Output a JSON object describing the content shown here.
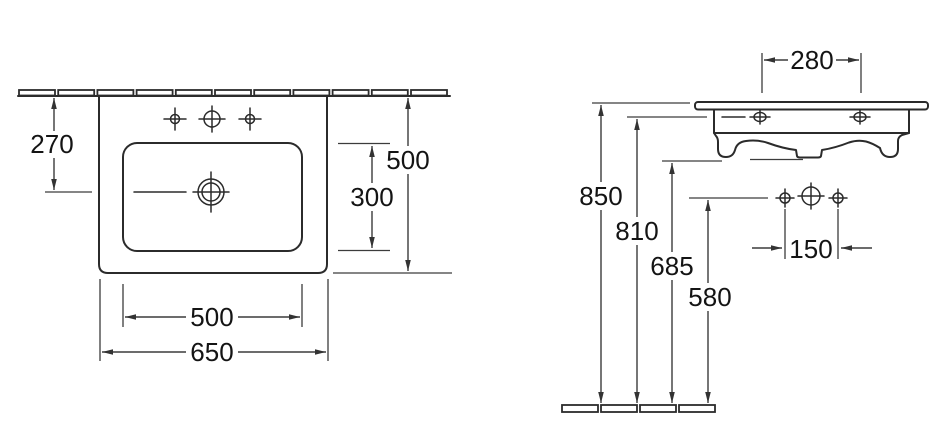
{
  "drawing": {
    "type": "technical-dimension-drawing",
    "subject": "wall-mounted washbasin, two orthographic views",
    "views": {
      "plan": {
        "name": "top view",
        "dims": {
          "front_to_drain": "270",
          "overall_depth": "500",
          "bowl_depth": "300",
          "bowl_width": "500",
          "overall_width": "650"
        }
      },
      "front": {
        "name": "side elevation",
        "dims": {
          "back_hole_spacing": "280",
          "rim_height": "850",
          "fixing_height": "810",
          "underside_height": "685",
          "drain_line_height": "580",
          "hole_spacing": "150"
        }
      }
    },
    "colors": {
      "line": "#2b2b2b",
      "dimension_line": "#3c3c3c",
      "text": "#141414",
      "background": "#ffffff"
    }
  }
}
